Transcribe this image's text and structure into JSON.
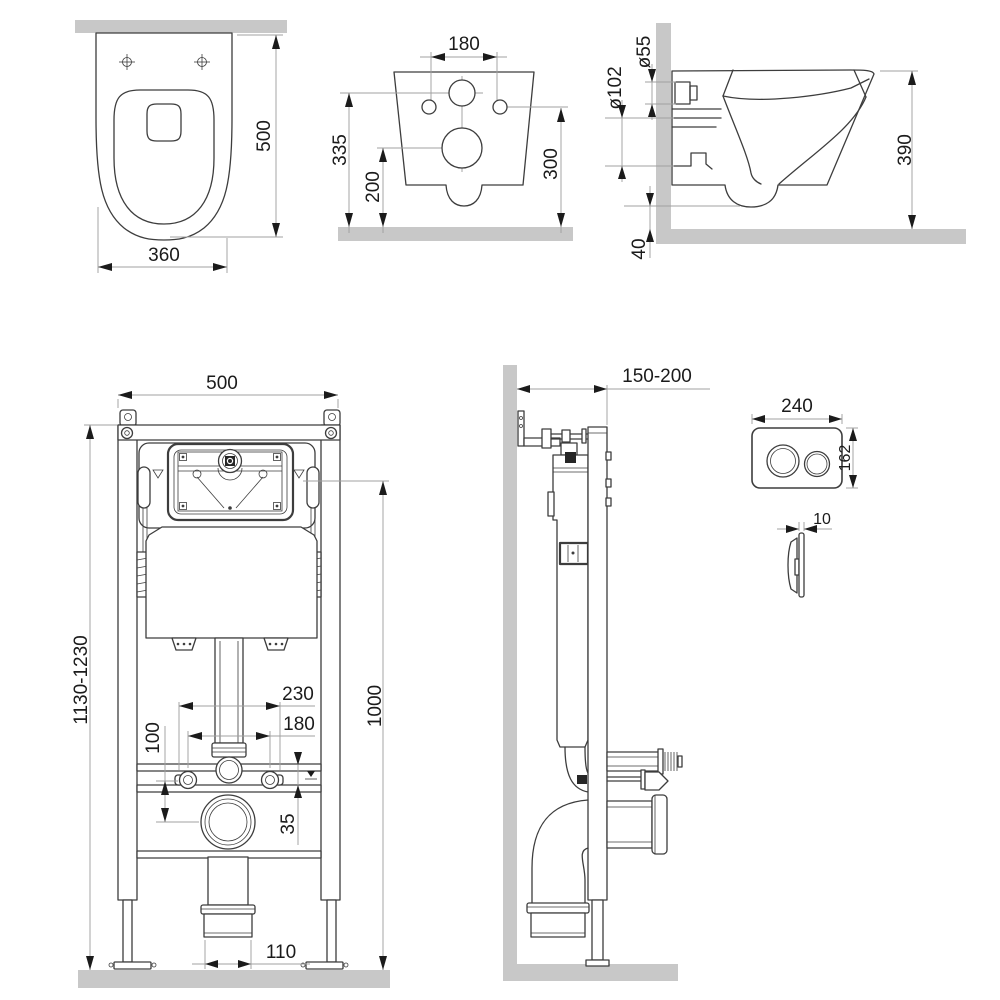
{
  "drawing": {
    "type": "technical-installation-drawing",
    "subject": "wall-hung toilet with concealed cistern frame and flush plate"
  },
  "colors": {
    "wall_fill": "#c8c8c8",
    "line": "#3d3d3d",
    "dim_line": "#a0a0a0",
    "text": "#1b1b1b",
    "background": "#ffffff"
  },
  "dims": {
    "bowl_top": {
      "depth": "500",
      "width": "360"
    },
    "bowl_rear": {
      "bolt_spacing": "180",
      "inlet_height": "335",
      "drain_height": "200",
      "bolt_height": "300"
    },
    "bowl_side": {
      "inlet_diameter": "ø55",
      "drain_diameter": "ø102",
      "height": "390",
      "floor_gap": "40"
    },
    "frame_front": {
      "width": "500",
      "height": "1130-1230",
      "marking_height": "1000",
      "rod_spacing": "230",
      "bolt_spacing": "180",
      "drain_offset": "100",
      "inlet_offset": "35",
      "outlet_width": "110"
    },
    "frame_side": {
      "depth": "150-200"
    },
    "flush_plate": {
      "width": "240",
      "height": "162",
      "thickness": "10"
    }
  }
}
